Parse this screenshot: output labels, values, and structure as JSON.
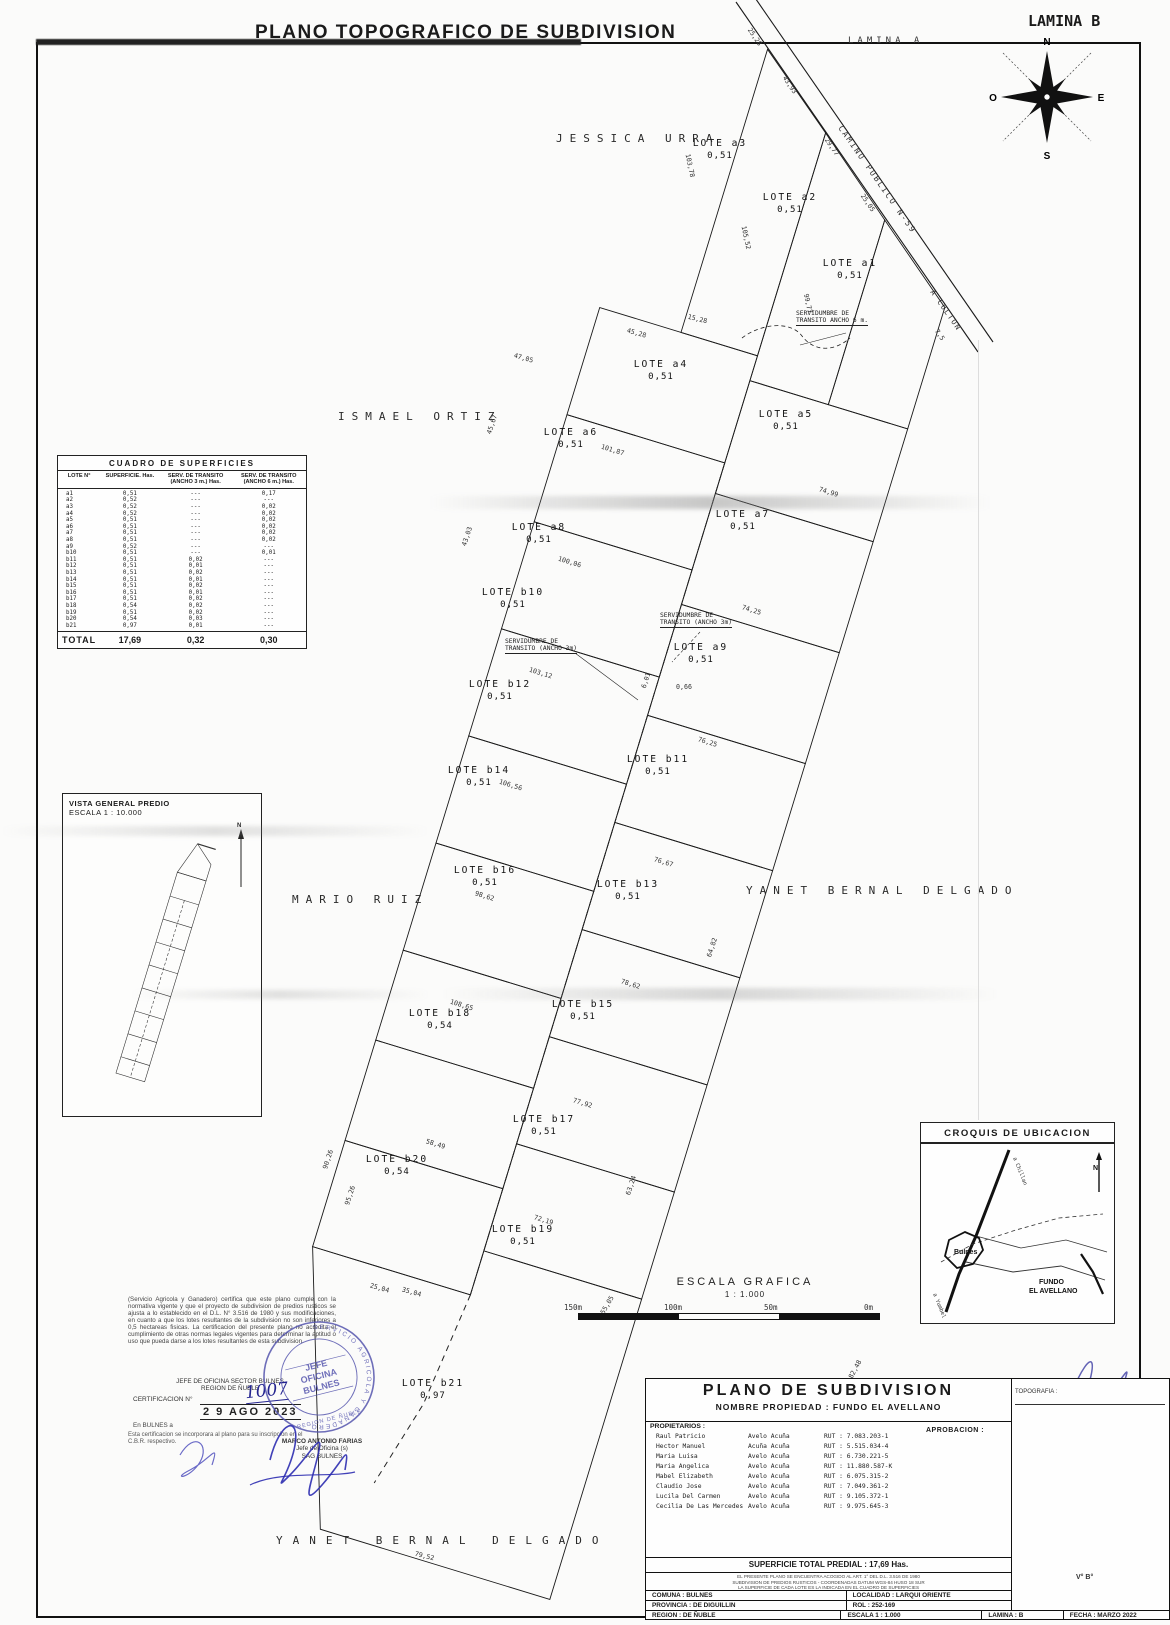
{
  "page": {
    "title": "PLANO TOPOGRAFICO DE SUBDIVISION",
    "lamina": "LAMINA B",
    "lamina_a": "LAMINA A"
  },
  "compass": {
    "n": "N",
    "s": "S",
    "e": "E",
    "o": "O"
  },
  "road": {
    "name": "CAMINO PUBLICO N-59",
    "dest": "A COLTON"
  },
  "neighbors": [
    {
      "id": "jessica",
      "label": "JESSICA URRA"
    },
    {
      "id": "ismael",
      "label": "ISMAEL ORTIZ"
    },
    {
      "id": "mario",
      "label": "MARIO RUIZ"
    },
    {
      "id": "yanet-east",
      "label": "YANET BERNAL DELGADO"
    },
    {
      "id": "yanet-south",
      "label": "YANET BERNAL DELGADO"
    }
  ],
  "plan": {
    "lots": [
      {
        "id": "a1",
        "label": "LOTE a1",
        "area": "0,51"
      },
      {
        "id": "a2",
        "label": "LOTE a2",
        "area": "0,51"
      },
      {
        "id": "a3",
        "label": "LOTE a3",
        "area": "0,51"
      },
      {
        "id": "a4",
        "label": "LOTE a4",
        "area": "0,51"
      },
      {
        "id": "a5",
        "label": "LOTE a5",
        "area": "0,51"
      },
      {
        "id": "a6",
        "label": "LOTE a6",
        "area": "0,51"
      },
      {
        "id": "a7",
        "label": "LOTE a7",
        "area": "0,51"
      },
      {
        "id": "a8",
        "label": "LOTE a8",
        "area": "0,51"
      },
      {
        "id": "a9",
        "label": "LOTE a9",
        "area": "0,51"
      },
      {
        "id": "b10",
        "label": "LOTE b10",
        "area": "0,51"
      },
      {
        "id": "b11",
        "label": "LOTE b11",
        "area": "0,51"
      },
      {
        "id": "b12",
        "label": "LOTE b12",
        "area": "0,51"
      },
      {
        "id": "b13",
        "label": "LOTE b13",
        "area": "0,51"
      },
      {
        "id": "b14",
        "label": "LOTE b14",
        "area": "0,51"
      },
      {
        "id": "b15",
        "label": "LOTE b15",
        "area": "0,51"
      },
      {
        "id": "b16",
        "label": "LOTE b16",
        "area": "0,51"
      },
      {
        "id": "b17",
        "label": "LOTE b17",
        "area": "0,51"
      },
      {
        "id": "b18",
        "label": "LOTE b18",
        "area": "0,54"
      },
      {
        "id": "b19",
        "label": "LOTE b19",
        "area": "0,51"
      },
      {
        "id": "b20",
        "label": "LOTE b20",
        "area": "0,54"
      },
      {
        "id": "b21",
        "label": "LOTE b21",
        "area": "0,97"
      }
    ],
    "serv3_l1": "SERVIDUMBRE DE",
    "serv3_l2": "TRANSITO (ANCHO 3m)",
    "serv6_l1": "SERVIDUMBRE DE",
    "serv6_l2": "TRANSITO ANCHO 6 m.",
    "dims": [
      "25,28",
      "43,93",
      "29,77",
      "25,05",
      "7,5",
      "103,78",
      "105,52",
      "99,77",
      "15,28",
      "45,28",
      "47,05",
      "101,87",
      "100,06",
      "103,12",
      "106,56",
      "98,62",
      "108,65",
      "58,49",
      "74,99",
      "74,25",
      "76,25",
      "76,67",
      "78,62",
      "77,92",
      "72,19",
      "79,52",
      "95,26",
      "90,26",
      "64,82",
      "63,24",
      "55,05",
      "182,48",
      "0,66",
      "6,01",
      "25,04",
      "35,04",
      "45,67",
      "43,03"
    ]
  },
  "surfaces_table": {
    "title": "CUADRO DE SUPERFICIES",
    "headers": [
      "LOTE N°",
      "SUPERFICIE. Has.",
      "SERV. DE TRANSITO (ANCHO 3 m.) Has.",
      "SERV. DE TRANSITO (ANCHO 6 m.) Has."
    ],
    "rows": [
      [
        "a1",
        "0,51",
        "---",
        "0,17"
      ],
      [
        "a2",
        "0,52",
        "---",
        "---"
      ],
      [
        "a3",
        "0,52",
        "---",
        "0,02"
      ],
      [
        "a4",
        "0,52",
        "---",
        "0,02"
      ],
      [
        "a5",
        "0,51",
        "---",
        "0,02"
      ],
      [
        "a6",
        "0,51",
        "---",
        "0,02"
      ],
      [
        "a7",
        "0,51",
        "---",
        "0,02"
      ],
      [
        "a8",
        "0,51",
        "---",
        "0,02"
      ],
      [
        "a9",
        "0,52",
        "---",
        "---"
      ],
      [
        "b10",
        "0,51",
        "---",
        "0,01"
      ],
      [
        "b11",
        "0,51",
        "0,02",
        "---"
      ],
      [
        "b12",
        "0,51",
        "0,01",
        "---"
      ],
      [
        "b13",
        "0,51",
        "0,02",
        "---"
      ],
      [
        "b14",
        "0,51",
        "0,01",
        "---"
      ],
      [
        "b15",
        "0,51",
        "0,02",
        "---"
      ],
      [
        "b16",
        "0,51",
        "0,01",
        "---"
      ],
      [
        "b17",
        "0,51",
        "0,02",
        "---"
      ],
      [
        "b18",
        "0,54",
        "0,02",
        "---"
      ],
      [
        "b19",
        "0,51",
        "0,02",
        "---"
      ],
      [
        "b20",
        "0,54",
        "0,03",
        "---"
      ],
      [
        "b21",
        "0,97",
        "0,01",
        "---"
      ]
    ],
    "total": [
      "TOTAL",
      "17,69",
      "0,32",
      "0,30"
    ]
  },
  "vista": {
    "l1": "VISTA GENERAL PREDIO",
    "l2": "ESCALA 1 : 10.000"
  },
  "escala": {
    "title": "ESCALA GRAFICA",
    "ratio": "1 : 1.000",
    "ticks": [
      "150m",
      "100m",
      "50m",
      "0m"
    ]
  },
  "croquis": {
    "title": "CROQUIS DE UBICACION",
    "town": "Bulnes",
    "predio_l1": "FUNDO",
    "predio_l2": "EL AVELLANO",
    "road_top": "a Chillan",
    "road_bottom": "a Yumbel",
    "north": "N"
  },
  "cert": {
    "paragraph": "(Servicio Agricola y Ganadero) certifica que este plano cumple con la normativa vigente y que el proyecto de subdivision de predios rusticos se ajusta a lo establecido en el D.L. N° 3.516 de 1980 y sus modificaciones, en cuanto a que los lotes resultantes de la subdivision no son inferiores a 0,5 hectareas fisicas. La certificacion del presente plano no acredita el cumplimiento de otras normas legales vigentes para determinar la aptitud o uso que pueda darse a los lotes resultantes de esta subdivision.",
    "office_l1": "JEFE DE OFICINA SECTOR BULNES",
    "office_l2": "REGION DE ÑUBLE",
    "cert_label": "CERTIFICACION N°",
    "cert_number": "1007",
    "date_stamp": "2 9  AGO  2023",
    "place": "En BULNES a",
    "note": "Esta certificacion se incorporara al plano para su inscripcion en el C.B.R. respectivo.",
    "stamp_ring": "SERVICIO AGRICOLA Y GANADERO",
    "stamp_c1": "JEFE",
    "stamp_c2": "OFICINA",
    "stamp_c3": "BULNES",
    "stamp_bottom": "REGION DE ÑUBLE",
    "signer_name": "MARCO ANTONIO FARIAS",
    "signer_role": "Jefe de Oficina (s)",
    "signer_office": "SAG BULNES"
  },
  "title_block": {
    "title": "PLANO DE SUBDIVISION",
    "subtitle": "NOMBRE PROPIEDAD  :  FUNDO EL AVELLANO",
    "topografia": "TOPOGRAFIA :",
    "owners_label": "PROPIETARIOS :",
    "aprobacion": "APROBACION :",
    "owners": [
      [
        "Raul     Patricio",
        "Avelo Acuña",
        "RUT : 7.083.203-1"
      ],
      [
        "Hector   Manuel",
        "Acuña Acuña",
        "RUT : 5.515.034-4"
      ],
      [
        "Maria    Luisa",
        "Avelo Acuña",
        "RUT : 6.730.221-5"
      ],
      [
        "Maria    Angelica",
        "Avelo Acuña",
        "RUT : 11.880.587-K"
      ],
      [
        "Mabel    Elizabeth",
        "Avelo Acuña",
        "RUT : 6.075.315-2"
      ],
      [
        "Claudio  Jose",
        "Avelo Acuña",
        "RUT : 7.049.361-2"
      ],
      [
        "Lucila Del Carmen",
        "Avelo Acuña",
        "RUT : 9.105.372-1"
      ],
      [
        "Cecilia De Las Mercedes",
        "Avelo Acuña",
        "RUT : 9.975.645-3"
      ]
    ],
    "superficie_total": "SUPERFICIE TOTAL PREDIAL  :  17,69 Has.",
    "fine_print": [
      "EL PRESENTE PLANO SE ENCUENTRA ACOGIDO AL ART. 1° DEL D.L. 3.516 DE 1980",
      "SUBDIVISION DE PREDIOS RUSTICOS - COORDENADAS DATUM WGS-84 HUSO 18 SUR",
      "LA SUPERFICIE DE CADA LOTE ES LA INDICADA EN EL CUADRO DE SUPERFICIES"
    ],
    "comuna": "COMUNA :  BULNES",
    "localidad": "LOCALIDAD :  LARQUI ORIENTE",
    "provincia": "PROVINCIA :  DE DIGUILLIN",
    "rol": "ROL : 252-169",
    "region": "REGION :  DE ÑUBLE",
    "escala": "ESCALA    1 : 1.000",
    "lamina": "LAMINA :  B",
    "fecha": "FECHA :  MARZO 2022",
    "vb": "V°  B°"
  }
}
